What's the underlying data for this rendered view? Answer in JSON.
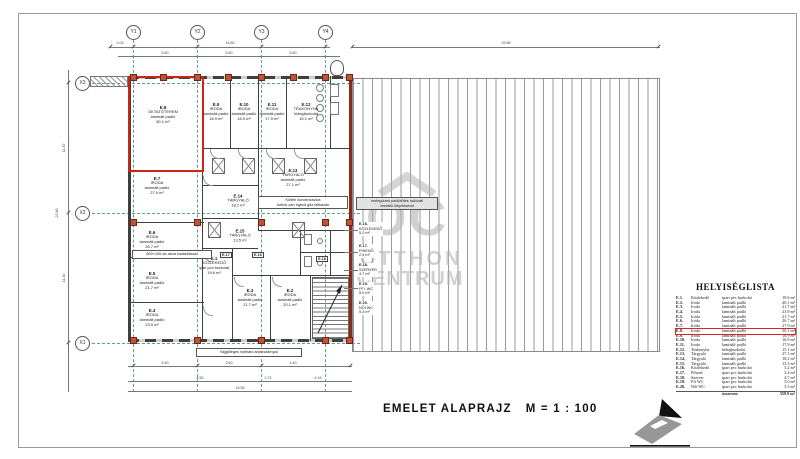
{
  "title": {
    "main": "EMELET  ALAPRAJZ",
    "scale": "M = 1 : 100"
  },
  "grid": {
    "y": [
      "Y1",
      "Y2",
      "Y3",
      "Y4"
    ],
    "x": [
      "X3",
      "X2",
      "X1"
    ]
  },
  "dims": {
    "top_left": "2.00",
    "top_overall": "16.80",
    "roof_overall": "29.56",
    "top_segs": [
      "5.60",
      "5.60",
      "5.60"
    ],
    "left_segs": [
      "11.40",
      "11.40"
    ],
    "left_overall": "22.80",
    "bottom_segs1": [
      "5.40",
      "3.60",
      "4.40"
    ],
    "bottom_segs2": [
      "8.55",
      "2.73",
      "4.16"
    ],
    "bottom_overall": "16.55"
  },
  "rooms": [
    {
      "id": "E.8",
      "name": "OKTATÓTEREM",
      "floor": "laminált padló",
      "area": "50.1 m²"
    },
    {
      "id": "E.9",
      "name": "IRODA",
      "floor": "laminált padló",
      "area": "16.9 m²"
    },
    {
      "id": "E.10",
      "name": "IRODA",
      "floor": "laminált padló",
      "area": "16.9 m²"
    },
    {
      "id": "E.11",
      "name": "IRODA",
      "floor": "laminált padló",
      "area": "17.9 m²"
    },
    {
      "id": "E.12",
      "name": "TEAKONYHA",
      "floor": "hidegburkolat",
      "area": "15.1 m²"
    },
    {
      "id": "E.7",
      "name": "IRODA",
      "floor": "laminált padló",
      "area": "27.9 m²"
    },
    {
      "id": "E.6",
      "name": "IRODA",
      "floor": "laminált padló",
      "area": "26.7 m²"
    },
    {
      "id": "E.5",
      "name": "IRODA",
      "floor": "laminált padló",
      "area": "21.7 m²"
    },
    {
      "id": "E.4",
      "name": "IRODA",
      "floor": "laminált padló",
      "area": "23.9 m²"
    },
    {
      "id": "E.13",
      "name": "TÁRGYALÓ",
      "floor": "laminált padló",
      "area": "27.1 m²"
    },
    {
      "id": "E.14",
      "name": "TÁRGYALÓ",
      "floor": "laminált padló",
      "area": "18.2 m²"
    },
    {
      "id": "E.15",
      "name": "TÁRGYALÓ",
      "floor": "laminált padló",
      "area": "13.5 m²"
    },
    {
      "id": "E.1",
      "name": "KÖZLEKEDŐ",
      "floor": "ipari pvc burkolat",
      "area": "19.6 m²"
    },
    {
      "id": "E.3",
      "name": "IRODA",
      "floor": "laminált padló",
      "area": "21.7 m²"
    },
    {
      "id": "E.2",
      "name": "IRODA",
      "floor": "laminált padló",
      "area": "20.1 m²"
    }
  ],
  "leaders": [
    {
      "id": "E.16.",
      "name": "KÖZLEKEDŐ",
      "floor": "ipari pvc burkolat",
      "area": "5.2 m²"
    },
    {
      "id": "E.17.",
      "name": "PIHENŐ",
      "floor": "ipari pvc burkolat",
      "area": "2.4 m²"
    },
    {
      "id": "E.18.",
      "name": "SZERVER",
      "floor": "ipari pvc burkolat",
      "area": "4.7 m²"
    },
    {
      "id": "E.19.",
      "name": "FFI. WC",
      "floor": "ipari pvc burkolat",
      "area": "5.0 m²"
    },
    {
      "id": "E.20.",
      "name": "NŐI WC",
      "floor": "ipari pvc burkolat",
      "area": "5.3 m²"
    }
  ],
  "tags": [
    "E.17",
    "E.16",
    "E.18"
  ],
  "notes": {
    "boiler_l1": "Kültéri kondenzációs",
    "boiler_l2": "turbós zárt égésű gáz falikazán",
    "heating_l1": "melegvizes padlófűtés hálózati",
    "heating_l2": "vezeték kiépítésével",
    "window_note": "függőleges nyitható ablakszárnyal",
    "shaft_note": "800×100-as akna kialakítással"
  },
  "watermark": {
    "oc": "OC",
    "line1": "OTTHON",
    "line2": "CENTRUM"
  },
  "room_list": {
    "title": "HELYISÉGLISTA",
    "rows": [
      {
        "no": "E.1.",
        "name": "Közlekedő",
        "floor": "ipari pvc burkolat",
        "area": "19.6 m²"
      },
      {
        "no": "E.2.",
        "name": "Iroda",
        "floor": "laminált padló",
        "area": "20.1 m²"
      },
      {
        "no": "E.3.",
        "name": "Iroda",
        "floor": "laminált padló",
        "area": "21.7 m²"
      },
      {
        "no": "E.4.",
        "name": "Iroda",
        "floor": "laminált padló",
        "area": "23.9 m²"
      },
      {
        "no": "E.5.",
        "name": "Iroda",
        "floor": "laminált padló",
        "area": "21.7 m²"
      },
      {
        "no": "E.6.",
        "name": "Iroda",
        "floor": "laminált padló",
        "area": "26.7 m²"
      },
      {
        "no": "E.7.",
        "name": "Iroda",
        "floor": "laminált padló",
        "area": "27.9 m²"
      },
      {
        "no": "E.8.",
        "name": "Iroda",
        "floor": "laminált padló",
        "area": "50.1 m²"
      },
      {
        "no": "E.9.",
        "name": "Iroda",
        "floor": "laminált padló",
        "area": "16.9 m²"
      },
      {
        "no": "E.10.",
        "name": "Iroda",
        "floor": "laminált padló",
        "area": "16.9 m²"
      },
      {
        "no": "E.11.",
        "name": "Iroda",
        "floor": "laminált padló",
        "area": "17.9 m²"
      },
      {
        "no": "E.12.",
        "name": "Teakonyha",
        "floor": "hidegburkolat",
        "area": "15.1 m²"
      },
      {
        "no": "E.13.",
        "name": "Tárgyaló",
        "floor": "laminált padló",
        "area": "27.1 m²"
      },
      {
        "no": "E.14.",
        "name": "Tárgyaló",
        "floor": "laminált padló",
        "area": "18.2 m²"
      },
      {
        "no": "E.15.",
        "name": "Tárgyaló",
        "floor": "laminált padló",
        "area": "13.5 m²"
      },
      {
        "no": "E.16.",
        "name": "Közlekedő",
        "floor": "ipari pvc burkolat",
        "area": "5.2 m²"
      },
      {
        "no": "E.17.",
        "name": "Pihenő",
        "floor": "ipari pvc burkolat",
        "area": "2.4 m²"
      },
      {
        "no": "E.18.",
        "name": "Szerver",
        "floor": "ipari pvc burkolat",
        "area": "4.7 m²"
      },
      {
        "no": "E.19.",
        "name": "Ffi WC",
        "floor": "ipari pvc burkolat",
        "area": "5.0 m²"
      },
      {
        "no": "E.20.",
        "name": "Női WC",
        "floor": "ipari pvc burkolat",
        "area": "5.3 m²"
      }
    ],
    "total_label": "összesen:",
    "total": "359.9 m²"
  },
  "colors": {
    "highlight_red": "#cc2517",
    "column_brown": "#b3593a",
    "grid_green": "#5fa08c",
    "watermark_gray": "#b4b4b4"
  }
}
